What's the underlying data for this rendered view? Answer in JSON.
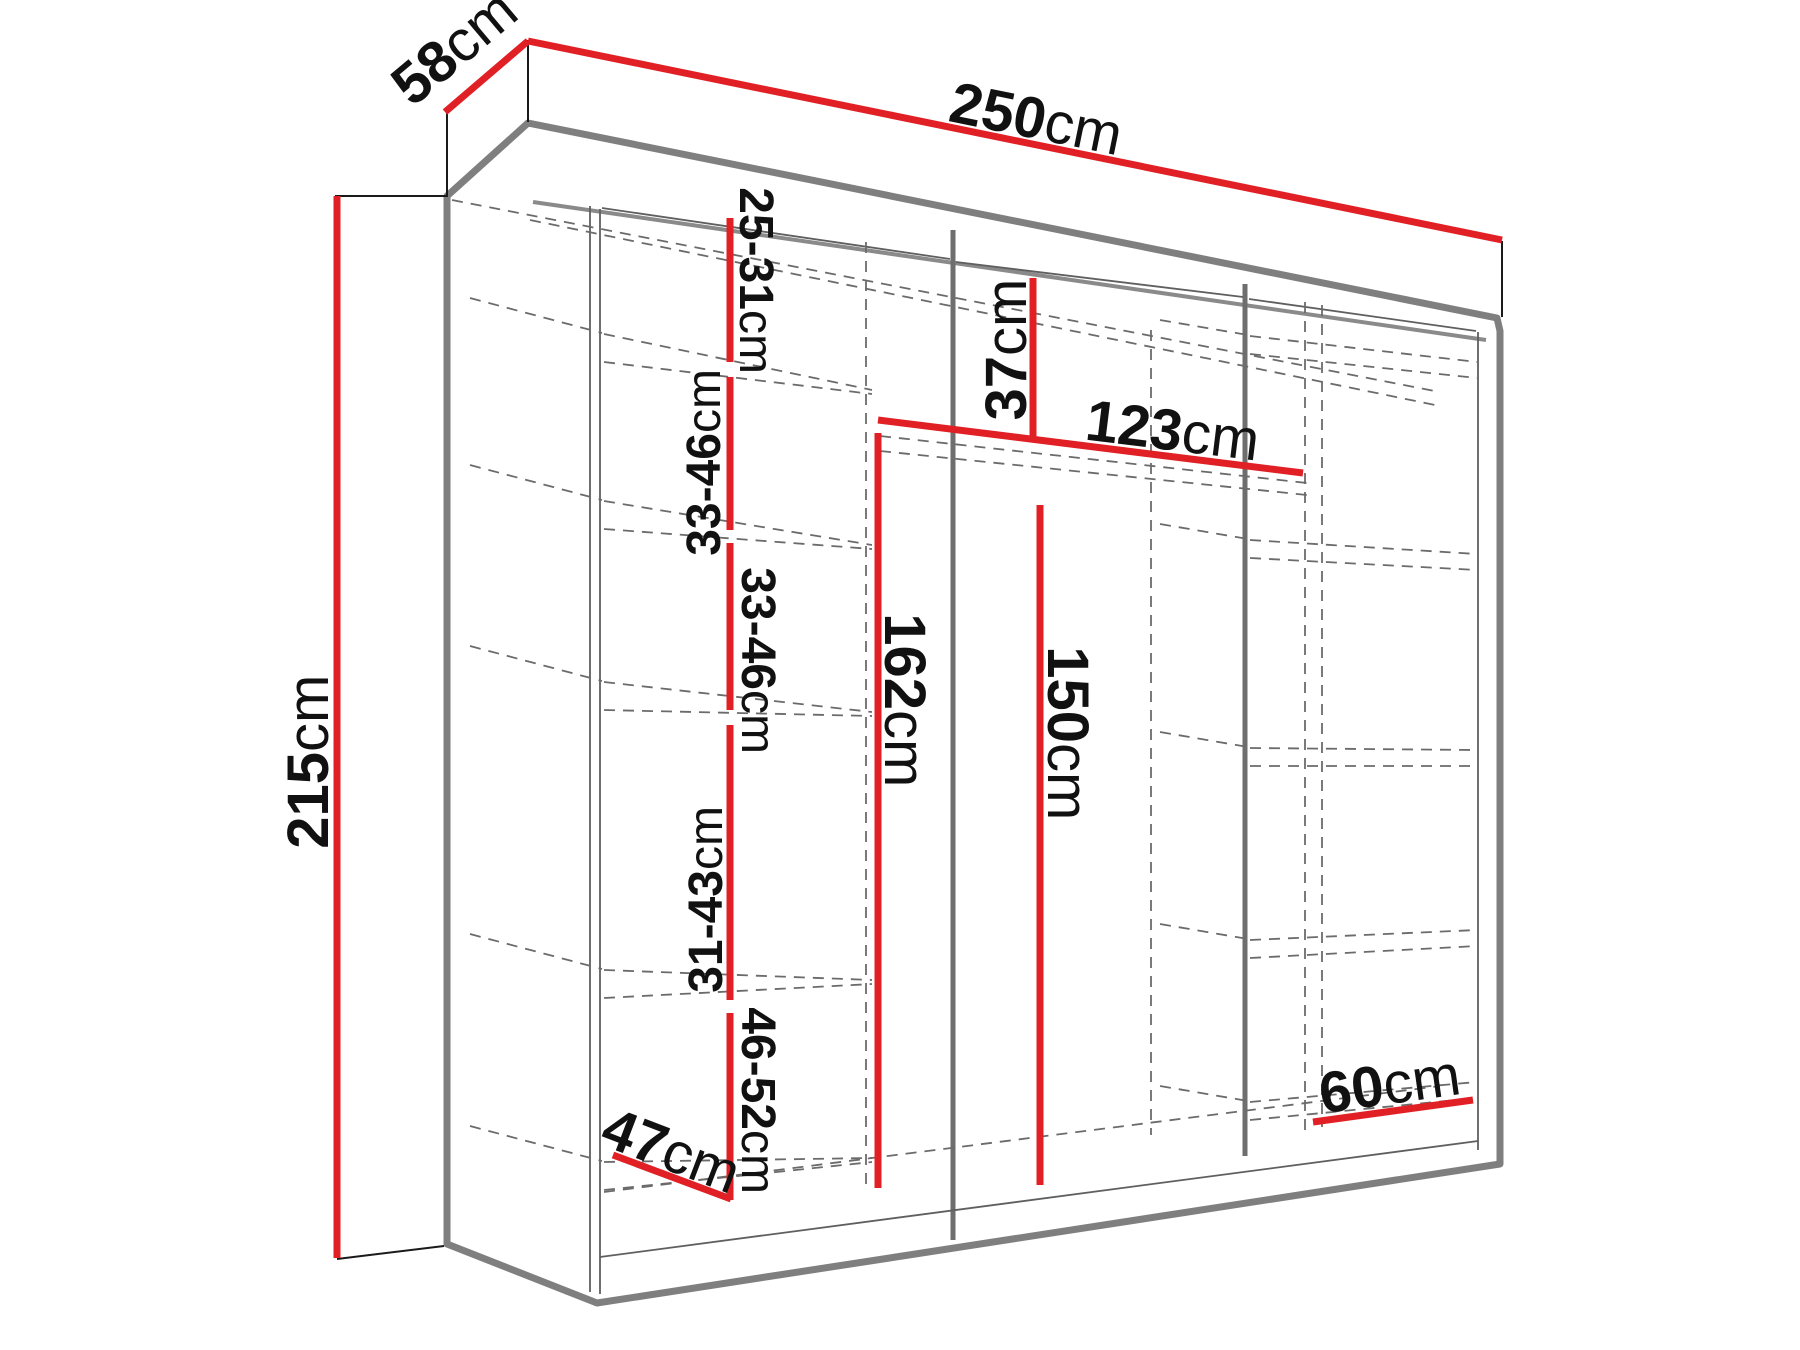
{
  "diagram": {
    "kind": "wardrobe-dimension-drawing",
    "unit": "cm",
    "accent_color": "#e12026",
    "line_color": "#7f7f7f",
    "dims": {
      "depth": {
        "num": "58",
        "unit": "cm"
      },
      "width": {
        "num": "250",
        "unit": "cm"
      },
      "height": {
        "num": "215",
        "unit": "cm"
      },
      "gap_top": {
        "num": "25-31",
        "unit": "cm"
      },
      "gap_upper": {
        "num": "33-46",
        "unit": "cm"
      },
      "gap_middle": {
        "num": "33-46",
        "unit": "cm"
      },
      "gap_lower": {
        "num": "31-43",
        "unit": "cm"
      },
      "gap_bottom": {
        "num": "46-52",
        "unit": "cm"
      },
      "top_clearance": {
        "num": "37",
        "unit": "cm"
      },
      "rail_width": {
        "num": "123",
        "unit": "cm"
      },
      "hang_height_left": {
        "num": "162",
        "unit": "cm"
      },
      "hang_height_right": {
        "num": "150",
        "unit": "cm"
      },
      "shelf_depth_left": {
        "num": "47",
        "unit": "cm"
      },
      "shelf_width_right": {
        "num": "60",
        "unit": "cm"
      }
    }
  }
}
